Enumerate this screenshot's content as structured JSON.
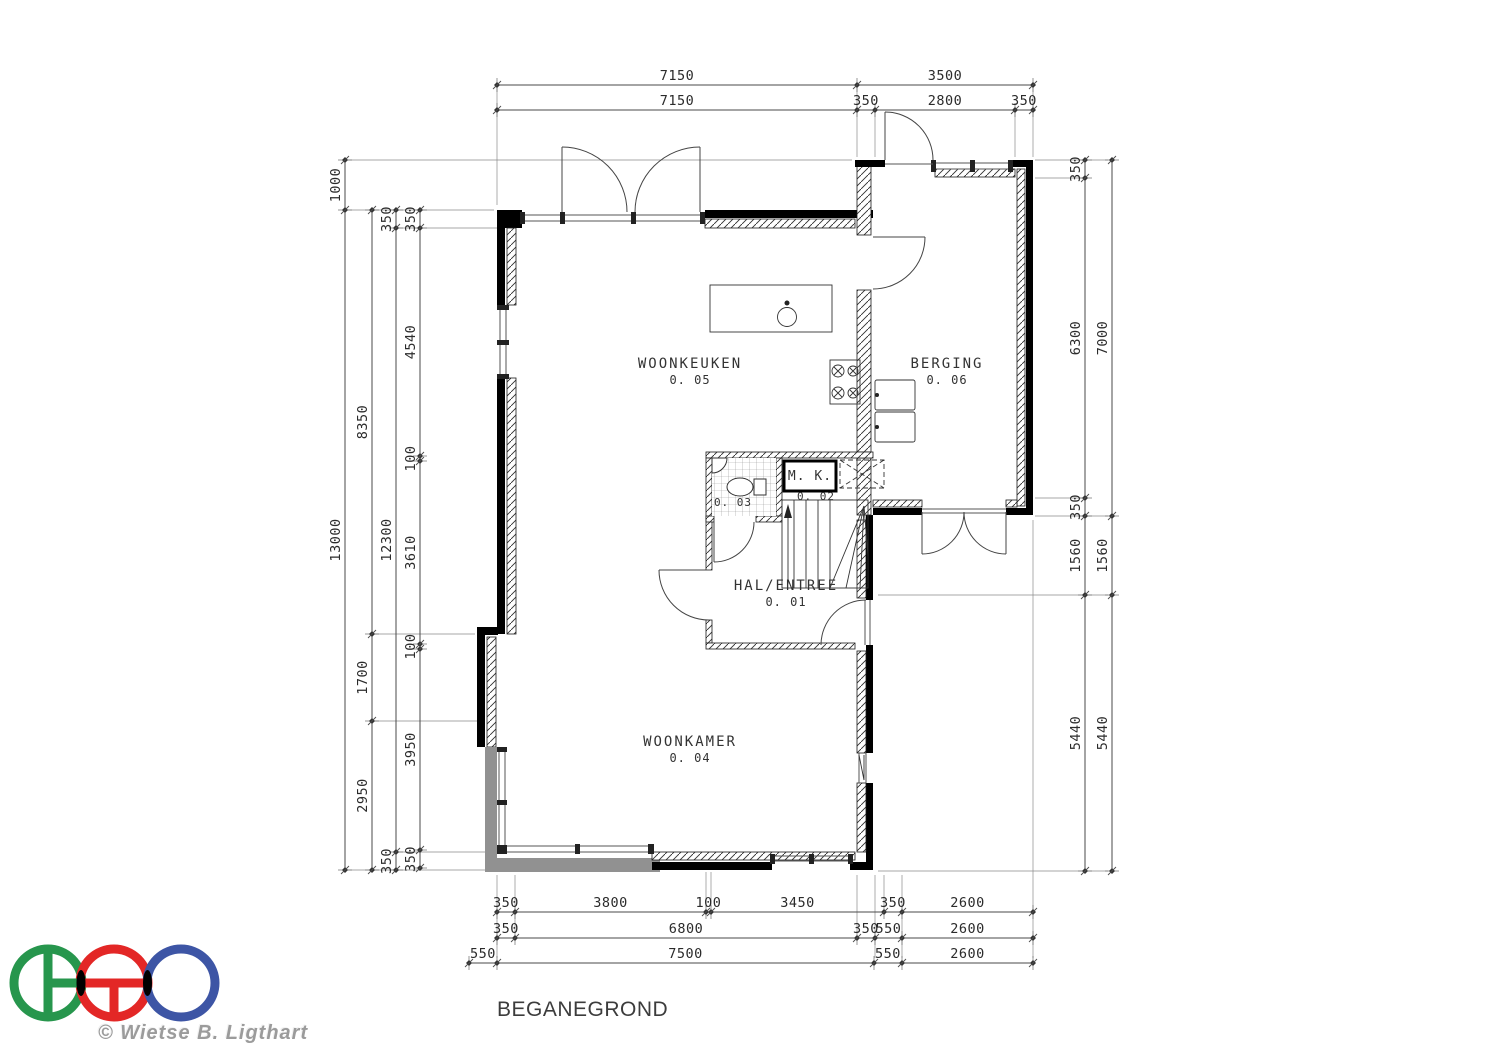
{
  "title": "BEGANEGROND",
  "copyright": "© Wietse B. Ligthart",
  "rooms": [
    {
      "name": "WOONKEUKEN",
      "number": "0. 05",
      "x": 690,
      "y": 368
    },
    {
      "name": "BERGING",
      "number": "0. 06",
      "x": 947,
      "y": 368
    },
    {
      "name": "HAL/ENTREE",
      "number": "0. 01",
      "x": 786,
      "y": 590
    },
    {
      "name": "WOONKAMER",
      "number": "0. 04",
      "x": 690,
      "y": 746
    }
  ],
  "small_labels": {
    "meter_closet": {
      "label": "M. K.",
      "number": "0. 02"
    },
    "toilet_number": "0. 03"
  },
  "dimensions": {
    "horizontal": [
      {
        "y": 85,
        "ticks": [
          497,
          857,
          1033
        ],
        "labels": [
          "7150",
          "3500"
        ]
      },
      {
        "y": 110,
        "ticks": [
          497,
          857,
          875,
          1015,
          1033
        ],
        "labels": [
          "7150",
          "350",
          "2800",
          "350"
        ]
      },
      {
        "y": 912,
        "ticks": [
          497,
          515,
          706,
          711,
          884,
          902,
          1033
        ],
        "labels": [
          "350",
          "3800",
          "100",
          "3450",
          "350",
          "2600"
        ]
      },
      {
        "y": 938,
        "ticks": [
          497,
          515,
          857,
          875,
          902,
          1033
        ],
        "labels": [
          "350",
          "6800",
          "350",
          "550",
          "2600"
        ]
      },
      {
        "y": 963,
        "ticks": [
          469,
          497,
          874,
          902,
          1033
        ],
        "labels": [
          "550",
          "7500",
          "550",
          "2600"
        ]
      }
    ],
    "vertical": [
      {
        "x": 345,
        "ticks": [
          160,
          210,
          870
        ],
        "labels": [
          "1000",
          "13000"
        ]
      },
      {
        "x": 372,
        "ticks": [
          210,
          634,
          721,
          870
        ],
        "labels": [
          "8350",
          "1700",
          "2950"
        ]
      },
      {
        "x": 396,
        "ticks": [
          210,
          228,
          852,
          870
        ],
        "labels": [
          "350",
          "12300",
          "350"
        ]
      },
      {
        "x": 420,
        "ticks": [
          210,
          228,
          456,
          461,
          644,
          649,
          850,
          868
        ],
        "labels": [
          "350",
          "4540",
          "100",
          "3610",
          "100",
          "3950",
          "350"
        ]
      },
      {
        "x": 1085,
        "ticks": [
          160,
          178,
          498,
          516,
          595,
          871
        ],
        "labels": [
          "350",
          "6300",
          "350",
          "1560",
          "5440"
        ]
      },
      {
        "x": 1112,
        "ticks": [
          160,
          516,
          595,
          871
        ],
        "labels": [
          "7000",
          "1560",
          "5440"
        ]
      }
    ]
  },
  "logo": {
    "colors": {
      "green": "#27964d",
      "red": "#e32726",
      "blue": "#3d55a5",
      "overlap": "#000000"
    }
  }
}
